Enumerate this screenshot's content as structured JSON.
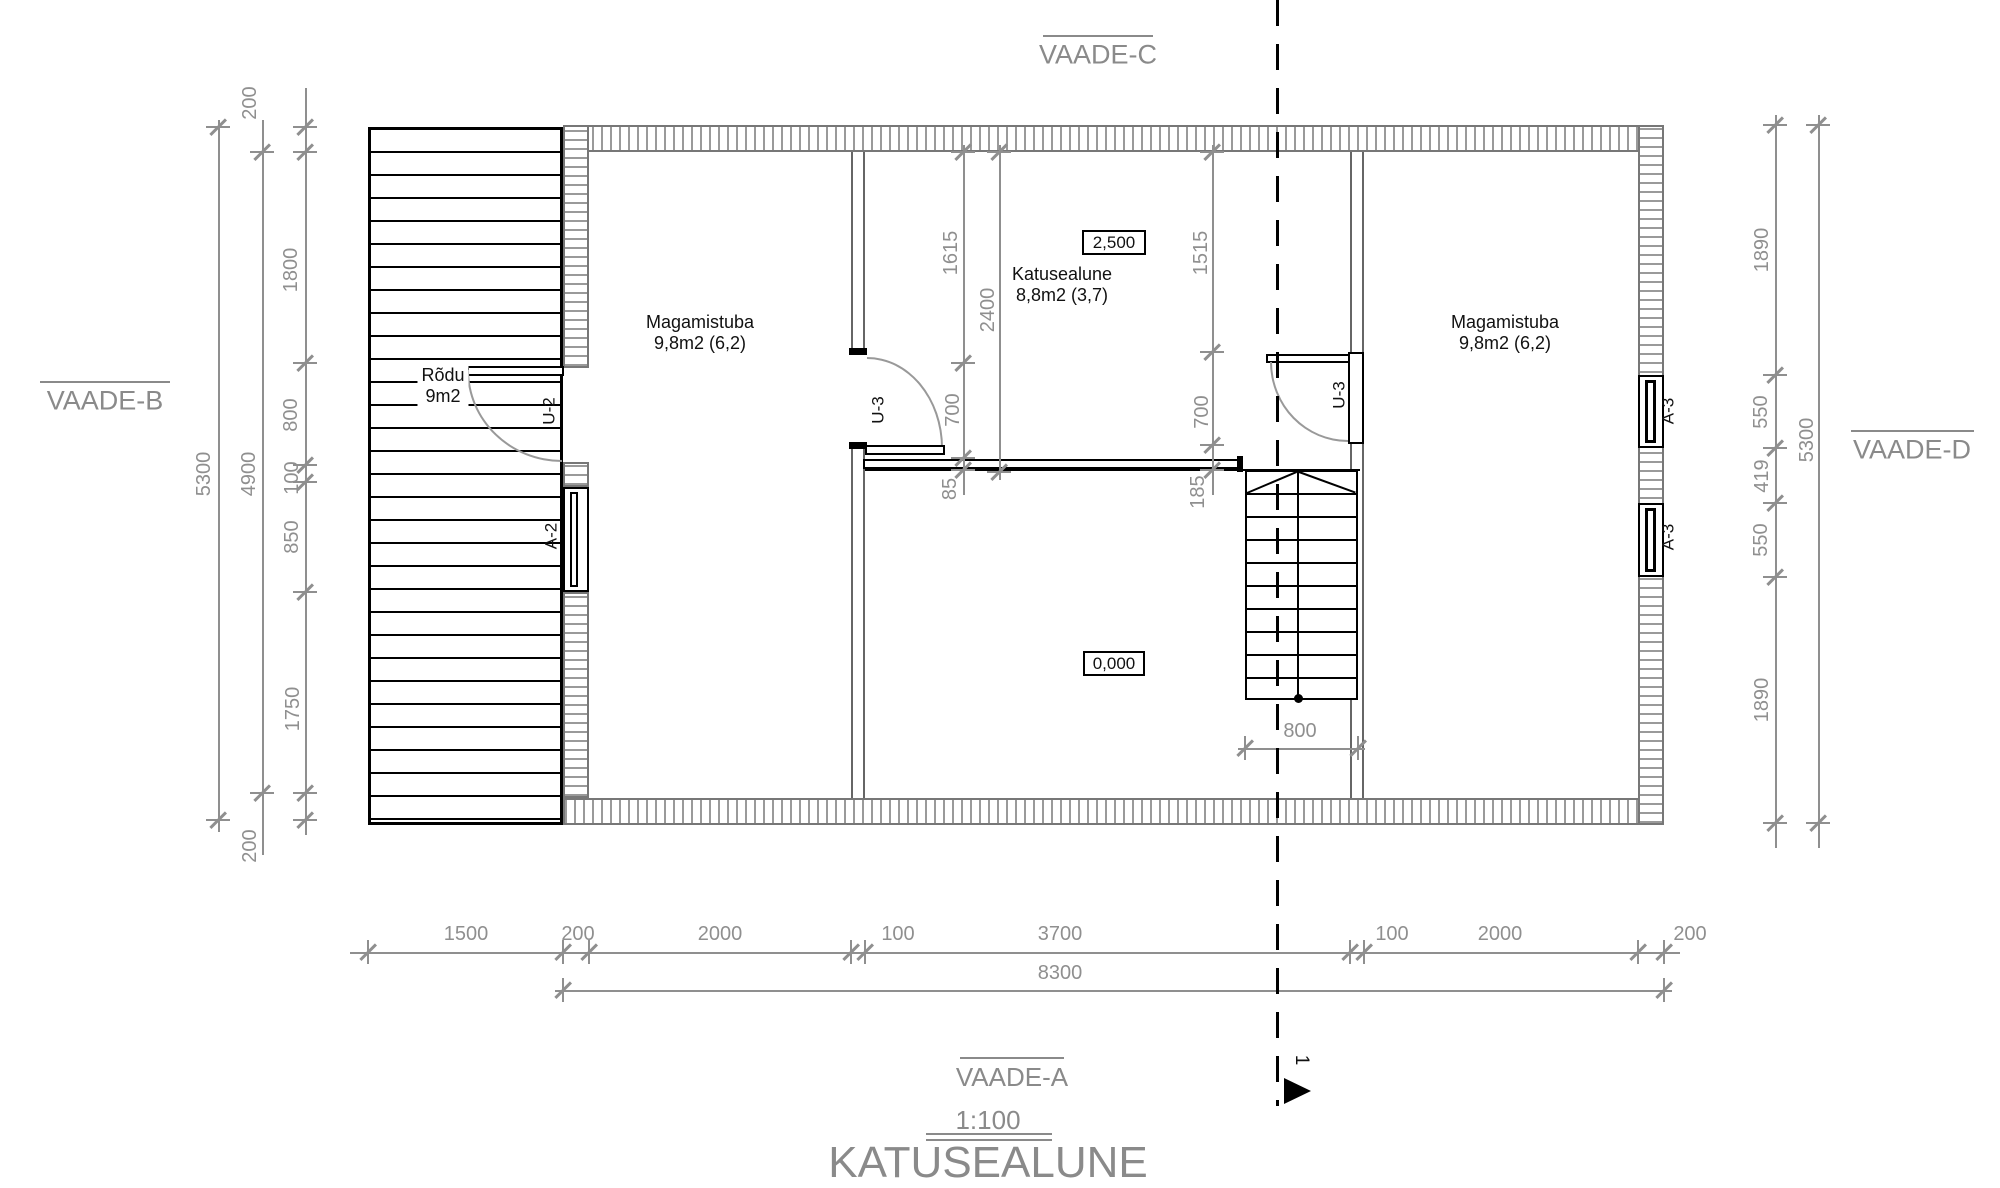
{
  "title": {
    "name": "KATUSEALUNE",
    "scale": "1:100"
  },
  "views": {
    "top": "VAADE-C",
    "left": "VAADE-B",
    "right": "VAADE-D",
    "bottom": "VAADE-A"
  },
  "section_marker": "1",
  "rooms": [
    {
      "id": "magamistuba-left",
      "name": "Magamistuba",
      "area": "9,8m2 (6,2)"
    },
    {
      "id": "katusealune-room",
      "name": "Katusealune",
      "area": "8,8m2 (3,7)"
    },
    {
      "id": "magamistuba-right",
      "name": "Magamistuba",
      "area": "9,8m2 (6,2)"
    },
    {
      "id": "rodu",
      "name": "Rõdu",
      "area": "9m2"
    }
  ],
  "levels": [
    {
      "value": "2,500"
    },
    {
      "value": "0,000"
    }
  ],
  "openings": [
    {
      "label": "U-2"
    },
    {
      "label": "A-2"
    },
    {
      "label": "U-3"
    },
    {
      "label": "U-3"
    },
    {
      "label": "A-3"
    },
    {
      "label": "A-3"
    }
  ],
  "dims": {
    "lines": [
      {
        "x": 218,
        "y": 120,
        "len": 712,
        "o": "v"
      },
      {
        "x": 262,
        "y": 120,
        "len": 735,
        "o": "v"
      },
      {
        "x": 305,
        "y": 88,
        "len": 747,
        "o": "v"
      },
      {
        "x": 1775,
        "y": 115,
        "len": 733,
        "o": "v"
      },
      {
        "x": 1818,
        "y": 115,
        "len": 733,
        "o": "v"
      },
      {
        "x": 350,
        "y": 952,
        "len": 1330,
        "o": "h"
      },
      {
        "x": 555,
        "y": 990,
        "len": 1117,
        "o": "h"
      },
      {
        "x": 963,
        "y": 145,
        "len": 350,
        "o": "v"
      },
      {
        "x": 999,
        "y": 145,
        "len": 335,
        "o": "v"
      },
      {
        "x": 1212,
        "y": 145,
        "len": 350,
        "o": "v"
      },
      {
        "x": 1238,
        "y": 748,
        "len": 127,
        "o": "h"
      }
    ],
    "ticks": [
      {
        "x": 305,
        "y": 127,
        "o": "v"
      },
      {
        "x": 305,
        "y": 152,
        "o": "v"
      },
      {
        "x": 305,
        "y": 363,
        "o": "v"
      },
      {
        "x": 305,
        "y": 465,
        "o": "v"
      },
      {
        "x": 305,
        "y": 482,
        "o": "v"
      },
      {
        "x": 305,
        "y": 592,
        "o": "v"
      },
      {
        "x": 305,
        "y": 793,
        "o": "v"
      },
      {
        "x": 305,
        "y": 820,
        "o": "v"
      },
      {
        "x": 262,
        "y": 152,
        "o": "v"
      },
      {
        "x": 262,
        "y": 793,
        "o": "v"
      },
      {
        "x": 218,
        "y": 127,
        "o": "v"
      },
      {
        "x": 218,
        "y": 820,
        "o": "v"
      },
      {
        "x": 1775,
        "y": 125,
        "o": "v"
      },
      {
        "x": 1775,
        "y": 375,
        "o": "v"
      },
      {
        "x": 1775,
        "y": 448,
        "o": "v"
      },
      {
        "x": 1775,
        "y": 503,
        "o": "v"
      },
      {
        "x": 1775,
        "y": 577,
        "o": "v"
      },
      {
        "x": 1775,
        "y": 823,
        "o": "v"
      },
      {
        "x": 1818,
        "y": 125,
        "o": "v"
      },
      {
        "x": 1818,
        "y": 823,
        "o": "v"
      },
      {
        "x": 368,
        "y": 952,
        "o": "h"
      },
      {
        "x": 563,
        "y": 952,
        "o": "h"
      },
      {
        "x": 589,
        "y": 952,
        "o": "h"
      },
      {
        "x": 851,
        "y": 952,
        "o": "h"
      },
      {
        "x": 865,
        "y": 952,
        "o": "h"
      },
      {
        "x": 1350,
        "y": 952,
        "o": "h"
      },
      {
        "x": 1364,
        "y": 952,
        "o": "h"
      },
      {
        "x": 1638,
        "y": 952,
        "o": "h"
      },
      {
        "x": 1664,
        "y": 952,
        "o": "h"
      },
      {
        "x": 563,
        "y": 990,
        "o": "h"
      },
      {
        "x": 1664,
        "y": 990,
        "o": "h"
      },
      {
        "x": 963,
        "y": 152,
        "o": "v"
      },
      {
        "x": 963,
        "y": 363,
        "o": "v"
      },
      {
        "x": 963,
        "y": 458,
        "o": "v"
      },
      {
        "x": 963,
        "y": 470,
        "o": "v"
      },
      {
        "x": 999,
        "y": 152,
        "o": "v"
      },
      {
        "x": 999,
        "y": 472,
        "o": "v"
      },
      {
        "x": 1212,
        "y": 152,
        "o": "v"
      },
      {
        "x": 1212,
        "y": 352,
        "o": "v"
      },
      {
        "x": 1212,
        "y": 445,
        "o": "v"
      },
      {
        "x": 1212,
        "y": 470,
        "o": "v"
      },
      {
        "x": 1245,
        "y": 748,
        "o": "h"
      },
      {
        "x": 1358,
        "y": 748,
        "o": "h"
      }
    ],
    "labels": [
      {
        "t": "200",
        "x": 250,
        "y": 103,
        "r": 1
      },
      {
        "t": "1800",
        "x": 291,
        "y": 270,
        "r": 1
      },
      {
        "t": "800",
        "x": 291,
        "y": 415,
        "r": 1
      },
      {
        "t": "100",
        "x": 292,
        "y": 478,
        "r": 1
      },
      {
        "t": "850",
        "x": 292,
        "y": 537,
        "r": 1
      },
      {
        "t": "1750",
        "x": 293,
        "y": 709,
        "r": 1
      },
      {
        "t": "200",
        "x": 250,
        "y": 846,
        "r": 1
      },
      {
        "t": "4900",
        "x": 249,
        "y": 474,
        "r": 1
      },
      {
        "t": "5300",
        "x": 204,
        "y": 474,
        "r": 1
      },
      {
        "t": "1890",
        "x": 1762,
        "y": 250,
        "r": 1
      },
      {
        "t": "550",
        "x": 1761,
        "y": 412,
        "r": 1
      },
      {
        "t": "419",
        "x": 1762,
        "y": 476,
        "r": 1
      },
      {
        "t": "550",
        "x": 1761,
        "y": 540,
        "r": 1
      },
      {
        "t": "1890",
        "x": 1762,
        "y": 700,
        "r": 1
      },
      {
        "t": "5300",
        "x": 1807,
        "y": 440,
        "r": 1
      },
      {
        "t": "1500",
        "x": 466,
        "y": 934
      },
      {
        "t": "200",
        "x": 578,
        "y": 934
      },
      {
        "t": "2000",
        "x": 720,
        "y": 934
      },
      {
        "t": "100",
        "x": 898,
        "y": 934
      },
      {
        "t": "3700",
        "x": 1060,
        "y": 934
      },
      {
        "t": "100",
        "x": 1392,
        "y": 934
      },
      {
        "t": "2000",
        "x": 1500,
        "y": 934
      },
      {
        "t": "200",
        "x": 1690,
        "y": 934
      },
      {
        "t": "8300",
        "x": 1060,
        "y": 973
      },
      {
        "t": "1615",
        "x": 951,
        "y": 253,
        "r": 1
      },
      {
        "t": "2400",
        "x": 988,
        "y": 310,
        "r": 1
      },
      {
        "t": "700",
        "x": 953,
        "y": 410,
        "r": 1
      },
      {
        "t": "85",
        "x": 950,
        "y": 489,
        "r": 1
      },
      {
        "t": "1515",
        "x": 1201,
        "y": 253,
        "r": 1
      },
      {
        "t": "700",
        "x": 1202,
        "y": 412,
        "r": 1
      },
      {
        "t": "185",
        "x": 1198,
        "y": 492,
        "r": 1
      },
      {
        "t": "800",
        "x": 1300,
        "y": 731
      }
    ]
  }
}
